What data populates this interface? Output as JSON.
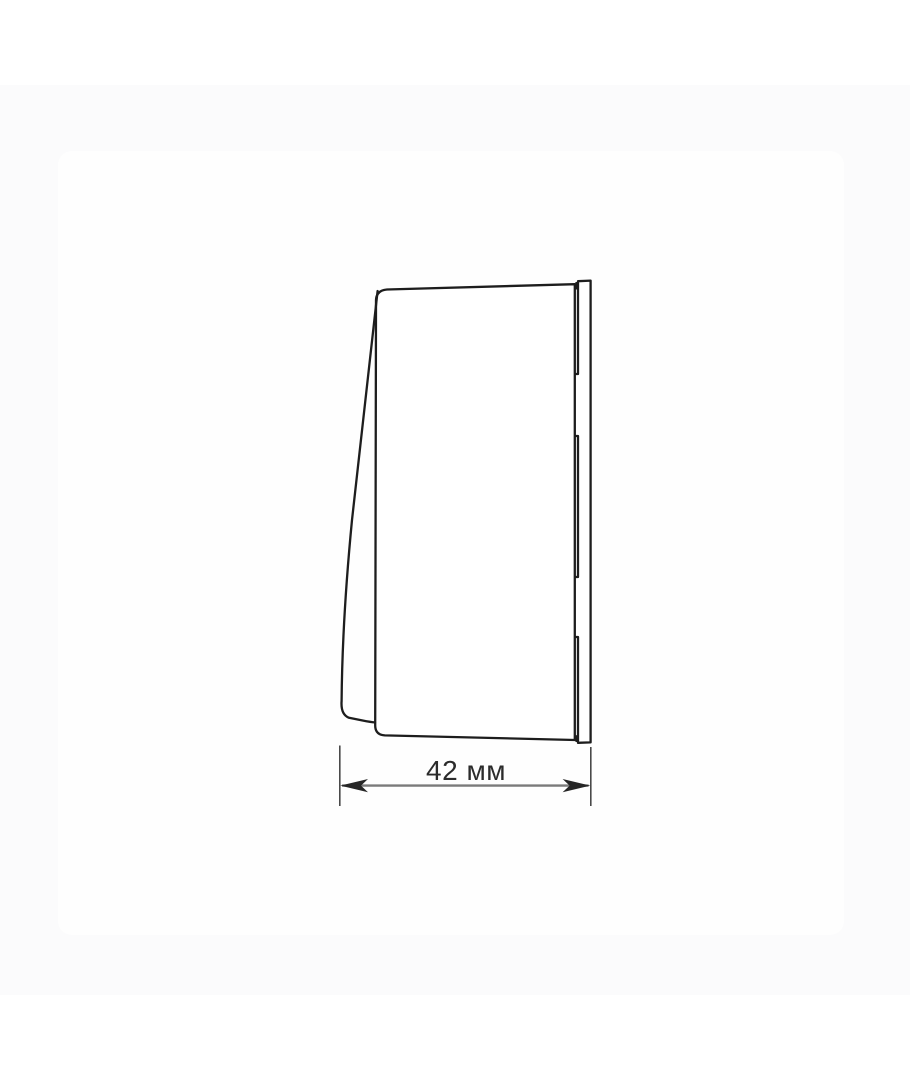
{
  "page": {
    "background_color": "#ffffff",
    "band_color": "#fbfbfc",
    "card_color": "#fefefe"
  },
  "drawing": {
    "subject": "wall-switch-side-view",
    "line_color": "#1d1d1d",
    "dimension": {
      "label": "42 мм",
      "value": 42,
      "unit": "мм",
      "extension_line_color": "#4a4a4a",
      "dimension_line_color": "#7a7a7a",
      "arrow_color": "#262626",
      "text_color": "#2b2b2b"
    }
  }
}
